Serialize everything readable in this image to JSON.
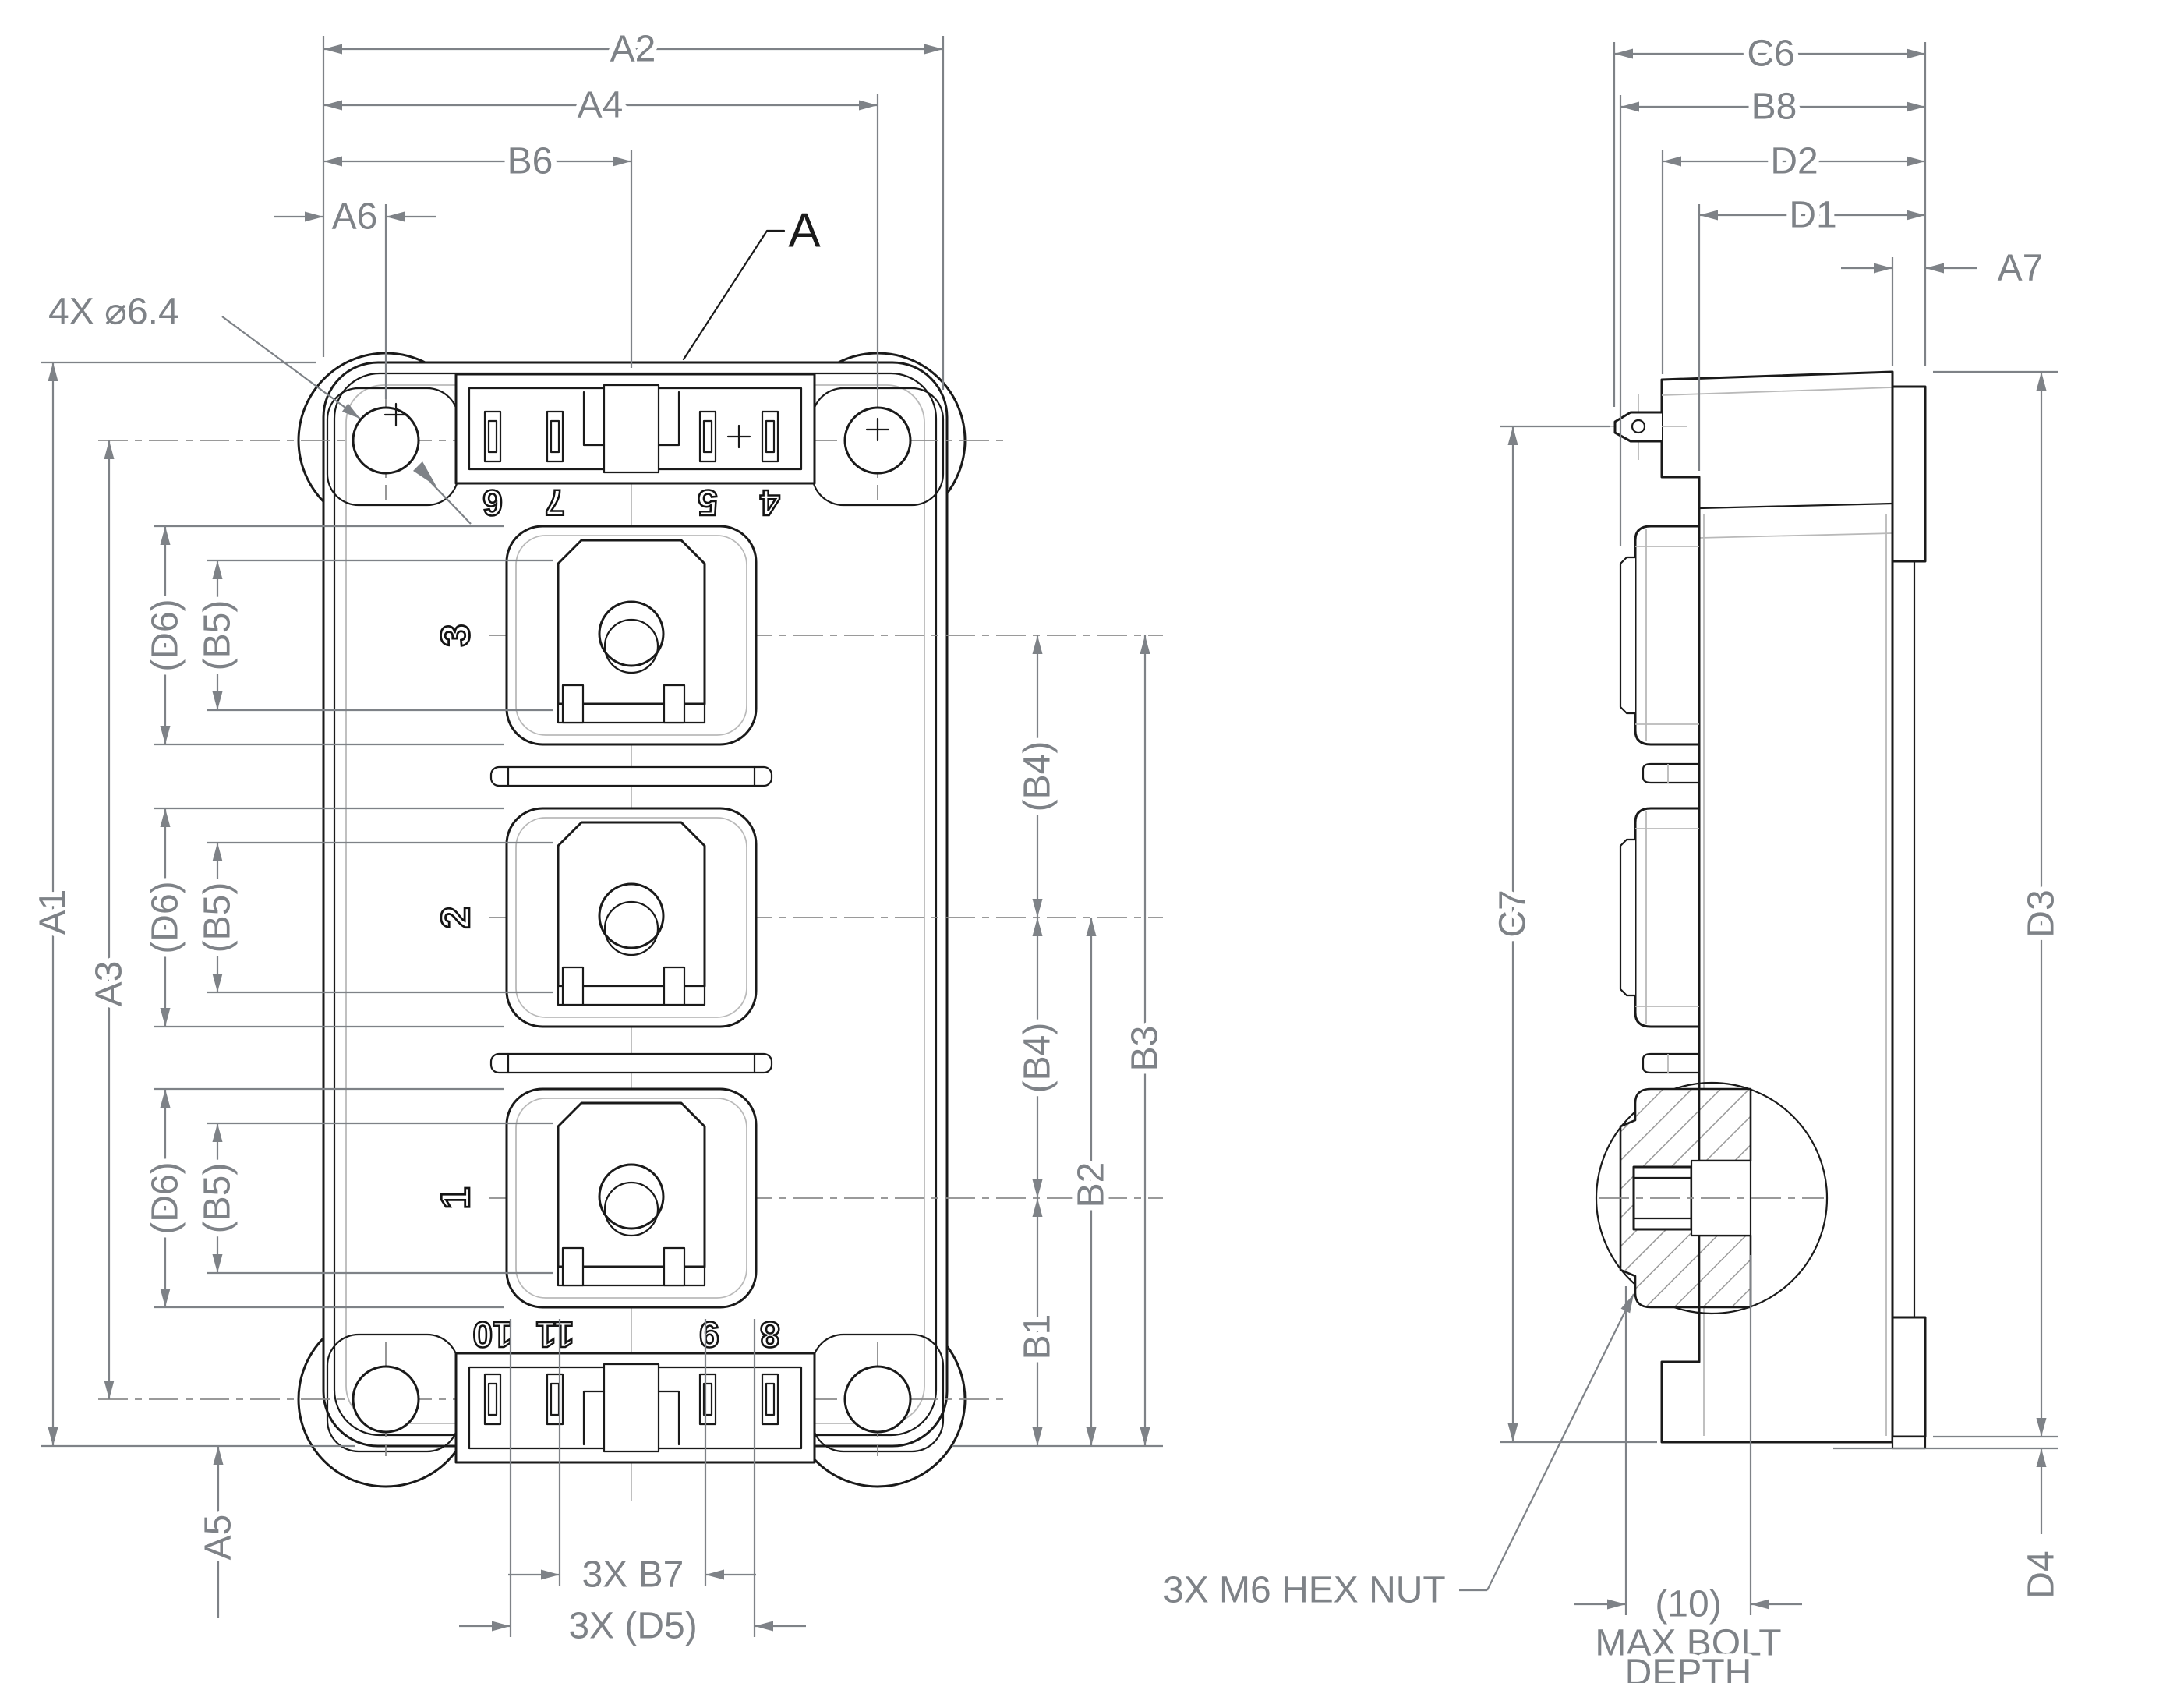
{
  "colors": {
    "line": "#1a1a1a",
    "dimension": "#7e8287",
    "thin_gray": "#b9b9b9"
  },
  "top_view": {
    "dims": {
      "a2": "A2",
      "a4": "A4",
      "b6": "B6",
      "a6": "A6",
      "a1": "A1",
      "a3": "A3",
      "a5": "A5",
      "d6": "(D6)",
      "b5": "(B5)",
      "b4": "(B4)",
      "b1": "B1",
      "b2": "B2",
      "b3": "B3",
      "b7": "3X B7",
      "d5": "3X (D5)"
    },
    "hole_callout": "4X ⌀6.4",
    "section_label": "A",
    "terminal_numbers_top": [
      "6",
      "7",
      "5",
      "4"
    ],
    "terminal_numbers_bottom": [
      "10",
      "11",
      "9",
      "8"
    ],
    "pad_numbers": [
      "3",
      "2",
      "1"
    ]
  },
  "side_view": {
    "dims": {
      "c6": "C6",
      "b8": "B8",
      "d2": "D2",
      "d1": "D1",
      "a7": "A7",
      "c7": "C7",
      "d3": "D3",
      "d4": "D4",
      "bolt_depth": "(10)"
    },
    "notes": {
      "hex_nut": "3X M6 HEX NUT",
      "max_bolt": "MAX BOLT",
      "depth": "DEPTH"
    }
  }
}
